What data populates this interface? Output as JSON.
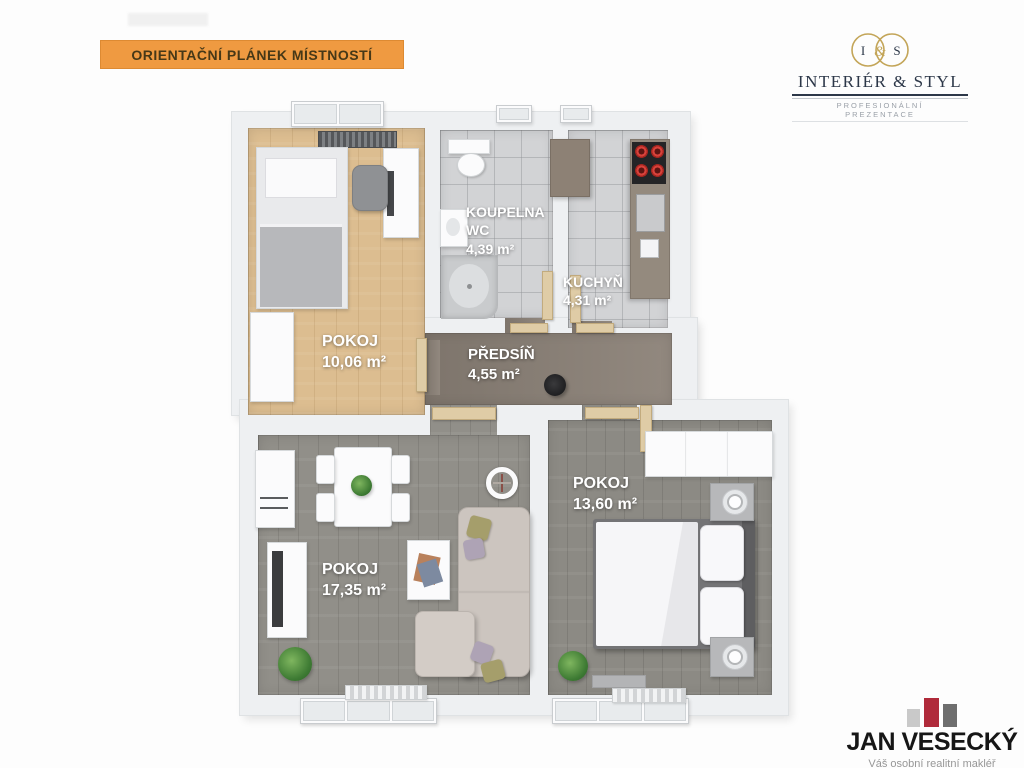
{
  "header": {
    "banner_title": "ORIENTAČNÍ PLÁNEK MÍSTNOSTÍ",
    "brand": {
      "monogram_i": "I",
      "monogram_amp": "&",
      "monogram_s": "S",
      "name": "INTERIÉR & STYL",
      "tagline": "PROFESIONÁLNÍ PREZENTACE"
    }
  },
  "floorplan": {
    "rooms": {
      "pokoj_top": {
        "name": "POKOJ",
        "area": "10,06 m²"
      },
      "koupelna": {
        "name_line1": "KOUPELNA",
        "name_line2": "WC",
        "area": "4,39 m²"
      },
      "kuchyn": {
        "name": "KUCHYŇ",
        "area": "4,31 m²"
      },
      "predsin": {
        "name": "PŘEDSÍŇ",
        "area": "4,55 m²"
      },
      "pokoj_right": {
        "name": "POKOJ",
        "area": "13,60 m²"
      },
      "pokoj_left": {
        "name": "POKOJ",
        "area": "17,35 m²"
      }
    }
  },
  "footer": {
    "agent_name": "JAN VESECKÝ",
    "agent_tagline": "Váš osobní realitní makléř"
  },
  "colors": {
    "banner_orange": "#ef9a41",
    "logo_gold": "#c3a558",
    "logo_navy": "#2c3748",
    "brand_red": "#b02a3a",
    "wood_floor": "#dcbd90",
    "tile_floor": "#d2d3d5",
    "hall_floor": "#8c8278",
    "gray_wood_floor": "#918f89"
  }
}
